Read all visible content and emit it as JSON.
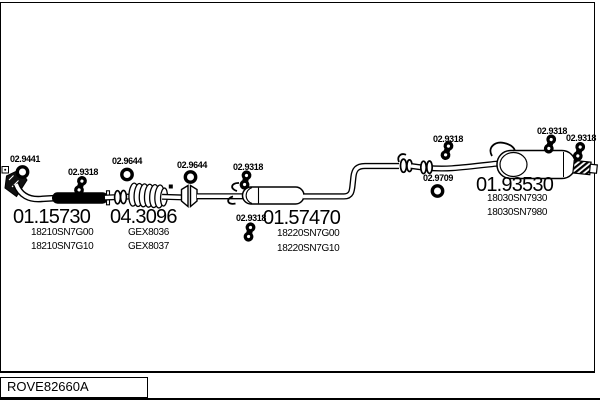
{
  "diagram": {
    "title_code": "ROVE82660A",
    "parts": [
      {
        "name": "front-pipe",
        "code": "01.15730",
        "oem": [
          "18210SN7G00",
          "18210SN7G10"
        ]
      },
      {
        "name": "catalytic-converter",
        "code": "04.3096",
        "oem": [
          "GEX8036",
          "GEX8037"
        ]
      },
      {
        "name": "centre-silencer",
        "code": "01.57470",
        "oem": [
          "18220SN7G00",
          "18220SN7G10"
        ]
      },
      {
        "name": "rear-silencer",
        "code": "01.93530",
        "oem": [
          "18030SN7930",
          "18030SN7980"
        ]
      }
    ],
    "fittings": [
      {
        "code": "02.9441",
        "type": "gasket-ring"
      },
      {
        "code": "02.9318",
        "type": "clamp"
      },
      {
        "code": "02.9644",
        "type": "gasket-ring"
      },
      {
        "code": "02.9644",
        "type": "gasket-ring"
      },
      {
        "code": "02.9318",
        "type": "clamp"
      },
      {
        "code": "02.9318",
        "type": "clamp"
      },
      {
        "code": "02.9318",
        "type": "clamp"
      },
      {
        "code": "02.9709",
        "type": "gasket-ring"
      },
      {
        "code": "02.9318",
        "type": "clamp"
      },
      {
        "code": "02.9318",
        "type": "clamp"
      }
    ],
    "colors": {
      "ink": "#000000",
      "paper": "#ffffff"
    }
  }
}
